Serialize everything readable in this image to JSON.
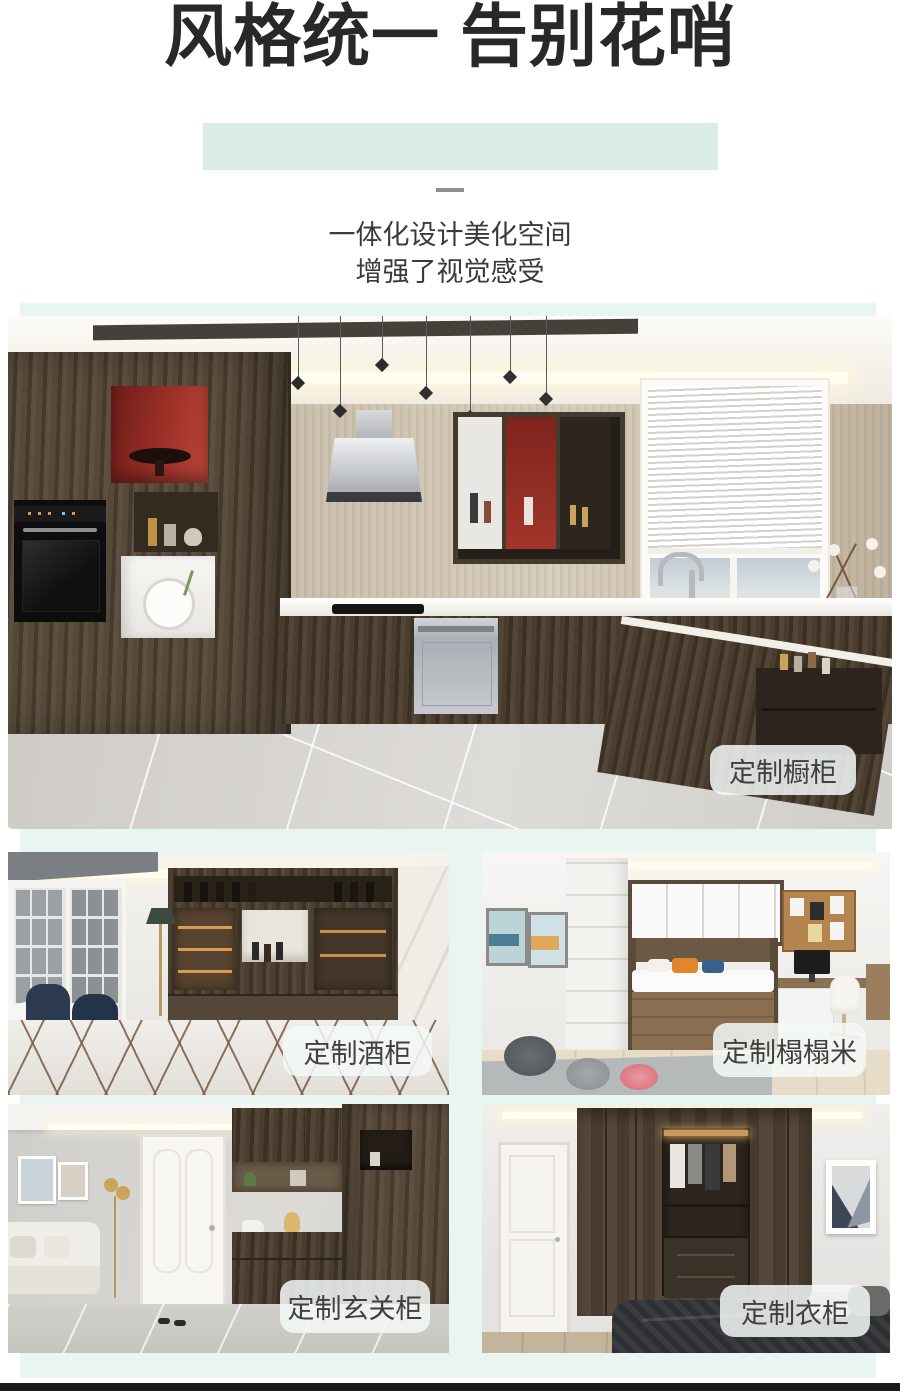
{
  "page": {
    "background": "#ffffff",
    "accent_highlight": "#d9ece6",
    "section_background": "#e9f5f1",
    "footer_bar_color": "#1b1b1b",
    "badge_background": "rgba(243,249,247,0.85)",
    "badge_text_color": "#3f3f3f",
    "title_color": "#282828"
  },
  "header": {
    "title": "风格统一 告别花哨",
    "subtitle_line1": "一体化设计美化空间",
    "subtitle_line2": "增强了视觉感受"
  },
  "gallery": {
    "items": [
      {
        "label": "定制橱柜",
        "scene": "kitchen-cabinets"
      },
      {
        "label": "定制酒柜",
        "scene": "wine-cabinet"
      },
      {
        "label": "定制榻榻米",
        "scene": "tatami"
      },
      {
        "label": "定制玄关柜",
        "scene": "entryway-cabinet"
      },
      {
        "label": "定制衣柜",
        "scene": "wardrobe"
      }
    ]
  }
}
